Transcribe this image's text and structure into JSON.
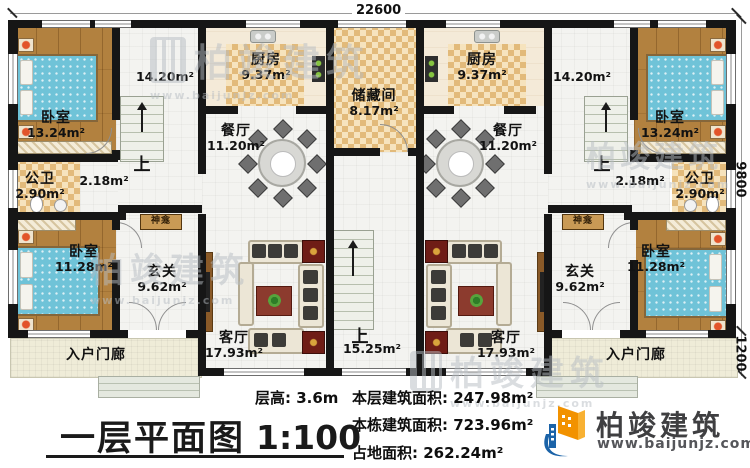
{
  "plan": {
    "dim_width": "22600",
    "dim_height": "9800",
    "dim_porch": "1200",
    "rooms": {
      "bedroom_front": {
        "name": "卧室",
        "area": "13.24m²"
      },
      "bedroom_rear": {
        "name": "卧室",
        "area": "11.28m²"
      },
      "kitchen": {
        "name": "厨房",
        "area": "9.37m²"
      },
      "dining": {
        "name": "餐厅",
        "area": "11.20m²"
      },
      "storage": {
        "name": "储藏间",
        "area": "8.17m²"
      },
      "bathroom": {
        "name": "公卫",
        "area": "2.90m²"
      },
      "hallway": {
        "area": "2.18m²"
      },
      "stairhall": {
        "area": "14.20m²",
        "up": "上"
      },
      "foyer": {
        "name": "玄关",
        "area": "9.62m²"
      },
      "shrine": {
        "name": "神龛"
      },
      "living": {
        "name": "客厅",
        "area": "17.93m²"
      },
      "porch": {
        "name": "入户门廊"
      },
      "center_stairs": {
        "up": "上",
        "area": "15.25m²"
      }
    }
  },
  "footer": {
    "floor_height": "层高: 3.6m",
    "floor_area": "本层建筑面积: 247.98m²",
    "building_area": "本栋建筑面积: 723.96m²",
    "footprint_area": "占地面积: 262.24m²",
    "title": "一层平面图",
    "scale": "1:100"
  },
  "brand": {
    "name": "柏竣建筑",
    "url": "www.baijunjz.com"
  },
  "watermark": {
    "name": "柏竣建筑",
    "url": "www.baijunjz.com"
  }
}
